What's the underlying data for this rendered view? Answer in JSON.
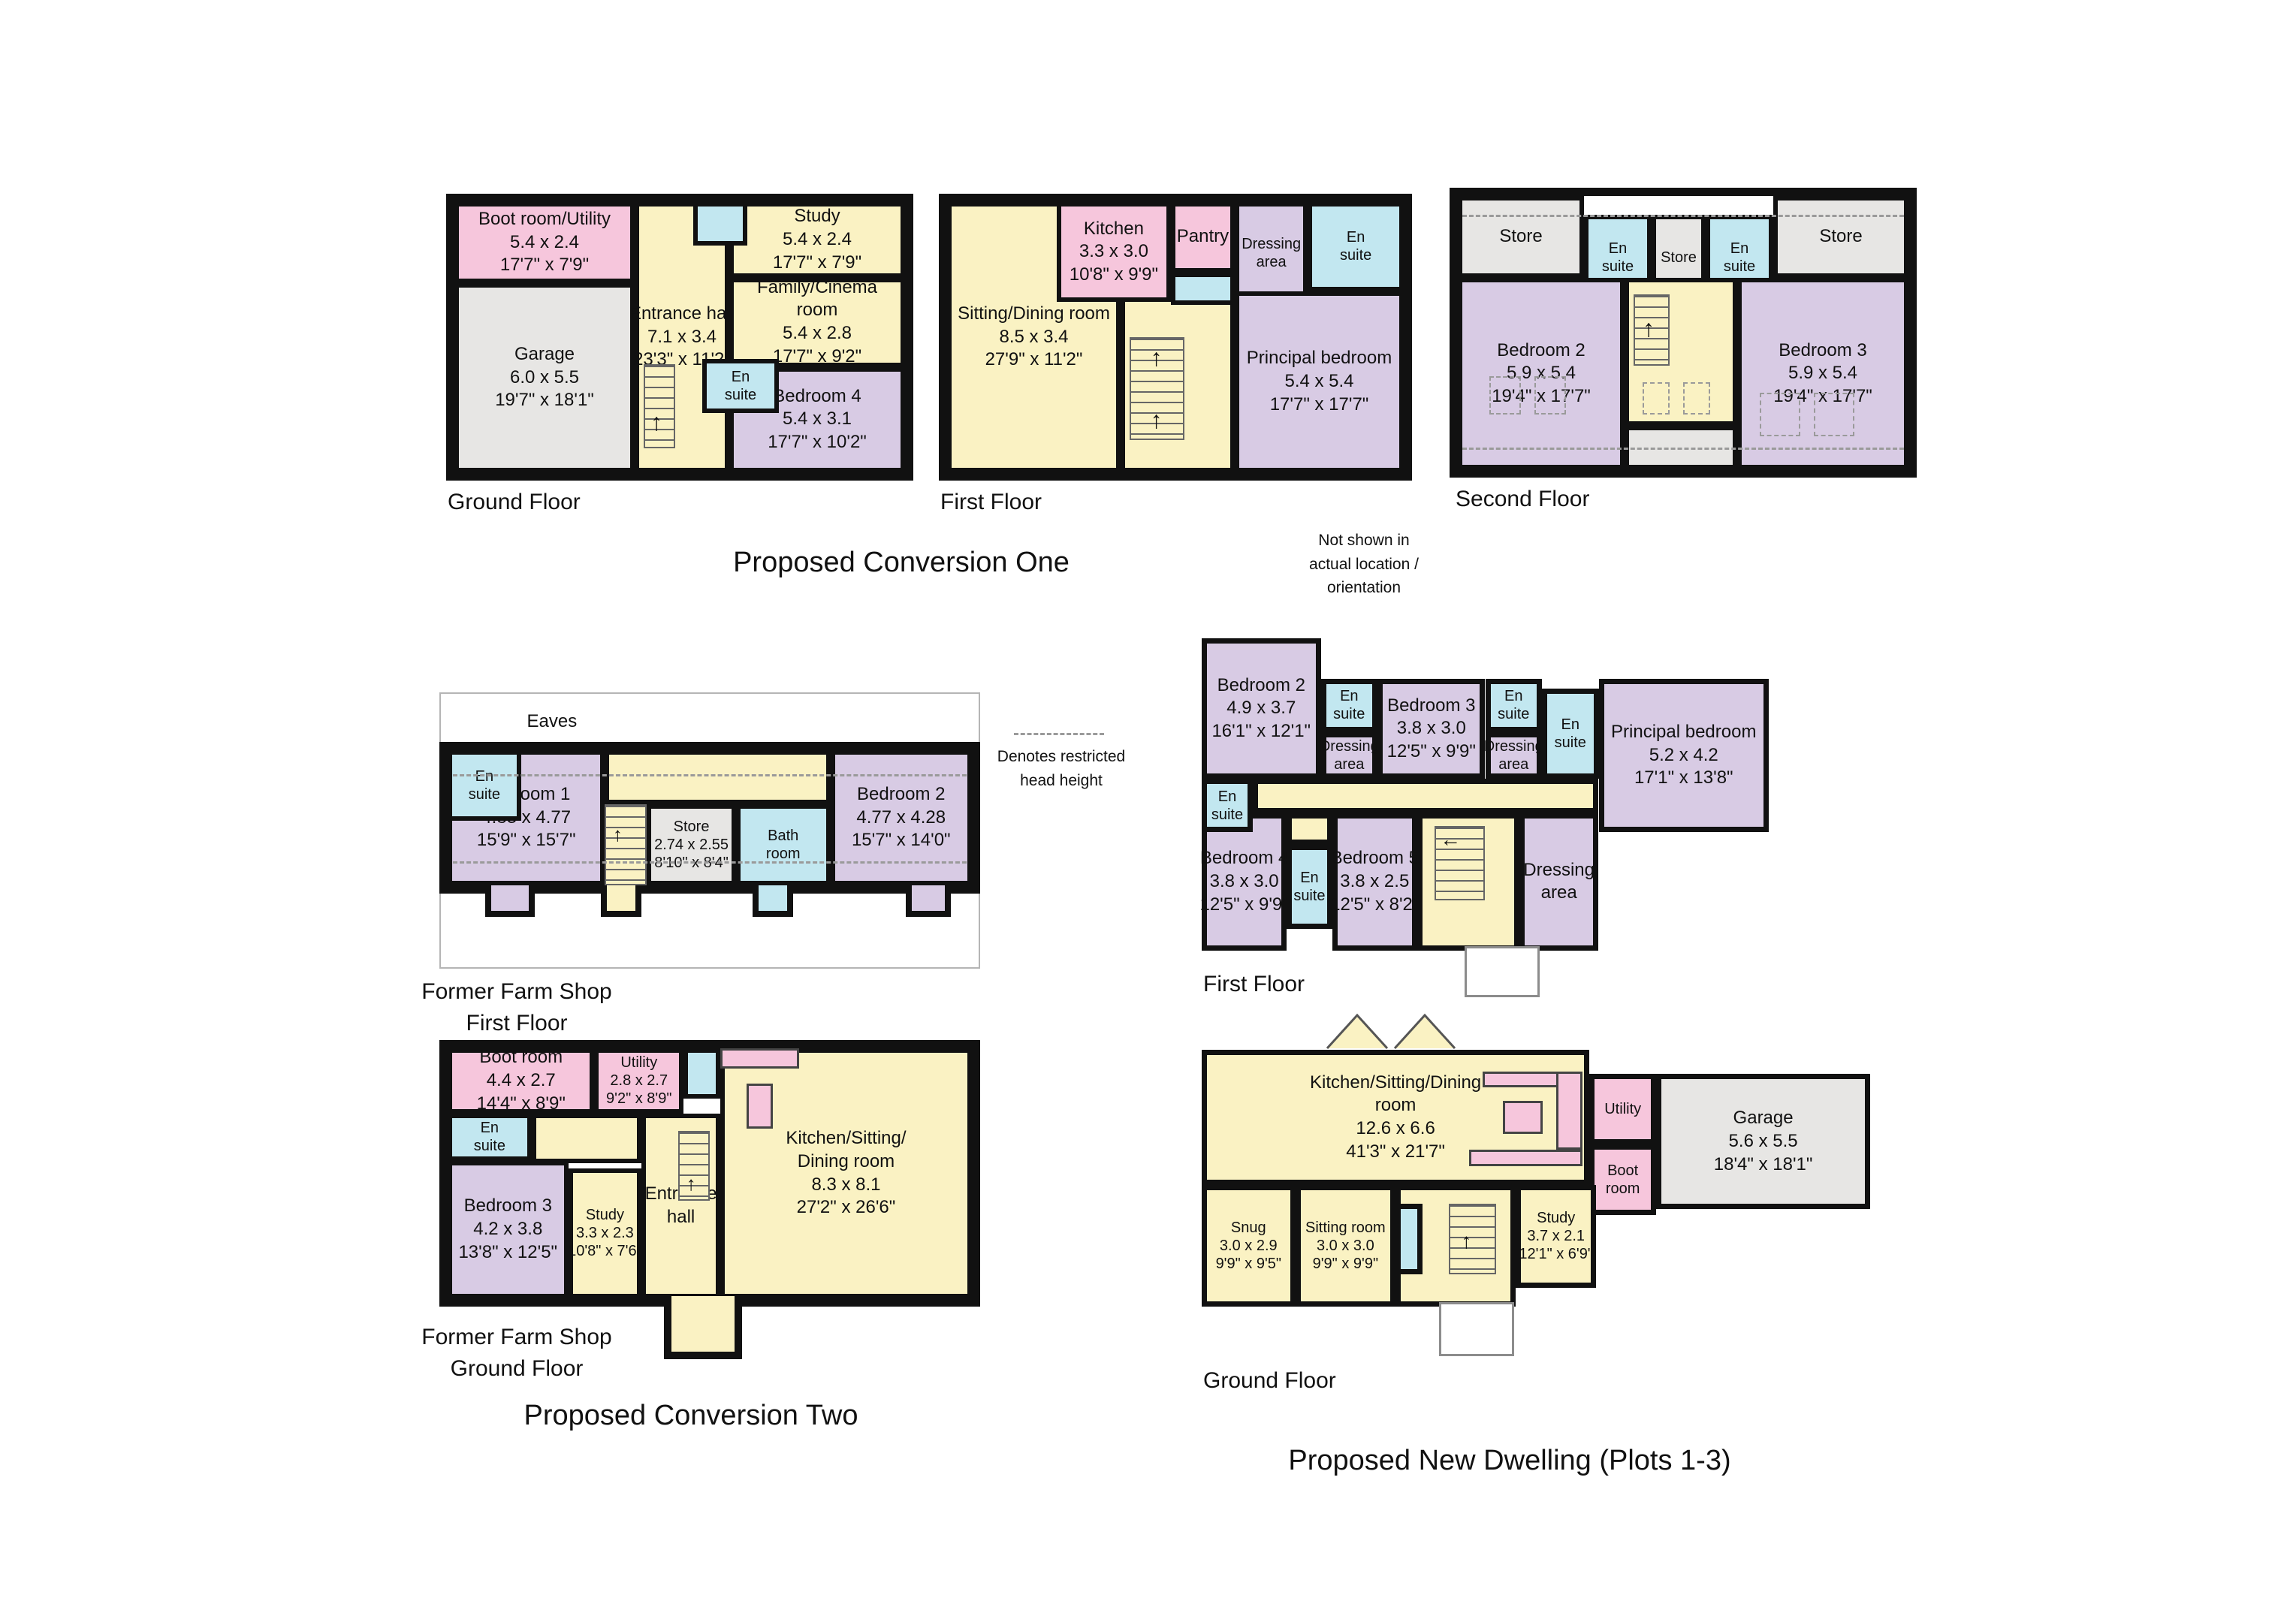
{
  "titles": {
    "conversion_one": "Proposed Conversion One",
    "conversion_two": "Proposed Conversion Two",
    "new_dwelling": "Proposed New Dwelling (Plots 1-3)"
  },
  "notes": {
    "orientation_lines": [
      "Not shown in",
      "actual location /",
      "orientation"
    ],
    "restricted_lines": [
      "Denotes restricted",
      "head height"
    ]
  },
  "colors": {
    "wall": "#111111",
    "room_pink": "#F6C6DC",
    "room_yellow": "#FAF2C3",
    "room_purple": "#D8CBE4",
    "room_blue": "#C2E7F0",
    "room_grey": "#E7E6E4"
  },
  "plans": {
    "c1_ground": {
      "caption": "Ground Floor",
      "rooms": {
        "boot": {
          "lines": [
            "Boot room/Utility",
            "5.4 x 2.4",
            "17'7\" x 7'9\""
          ]
        },
        "garage": {
          "lines": [
            "Garage",
            "6.0 x 5.5",
            "19'7\" x 18'1\""
          ]
        },
        "hall": {
          "lines": [
            "Entrance hall",
            "7.1 x 3.4",
            "23'3\" x 11'2\""
          ]
        },
        "study": {
          "lines": [
            "Study",
            "5.4 x 2.4",
            "17'7\" x 7'9\""
          ]
        },
        "family": {
          "lines": [
            "Family/Cinema",
            "room",
            "5.4 x 2.8",
            "17'7\" x 9'2\""
          ]
        },
        "ensuite": {
          "lines": [
            "En",
            "suite"
          ]
        },
        "bedroom4": {
          "lines": [
            "Bedroom 4",
            "5.4 x 3.1",
            "17'7\" x 10'2\""
          ]
        }
      }
    },
    "c1_first": {
      "caption": "First Floor",
      "rooms": {
        "sitting": {
          "lines": [
            "Sitting/Dining room",
            "8.5 x 3.4",
            "27'9\" x 11'2\""
          ]
        },
        "kitchen": {
          "lines": [
            "Kitchen",
            "3.3 x 3.0",
            "10'8\" x 9'9\""
          ]
        },
        "pantry": {
          "lines": [
            "Pantry"
          ]
        },
        "dressing": {
          "lines": [
            "Dressing",
            "area"
          ]
        },
        "ensuite": {
          "lines": [
            "En",
            "suite"
          ]
        },
        "principal": {
          "lines": [
            "Principal bedroom",
            "5.4 x 5.4",
            "17'7\" x 17'7\""
          ]
        }
      }
    },
    "c1_second": {
      "caption": "Second Floor",
      "rooms": {
        "store_left": {
          "lines": [
            "Store"
          ]
        },
        "ensuite_left": {
          "lines": [
            "En",
            "suite"
          ]
        },
        "store_mid": {
          "lines": [
            "Store"
          ]
        },
        "ensuite_right": {
          "lines": [
            "En",
            "suite"
          ]
        },
        "store_right": {
          "lines": [
            "Store"
          ]
        },
        "bedroom2": {
          "lines": [
            "Bedroom 2",
            "5.9 x 5.4",
            "19'4\" x 17'7\""
          ]
        },
        "bedroom3": {
          "lines": [
            "Bedroom 3",
            "5.9 x 5.4",
            "19'4\" x 17'7\""
          ]
        }
      }
    },
    "ffs_first": {
      "caption_lines": [
        "Former Farm Shop",
        "First Floor"
      ],
      "eaves": "Eaves",
      "rooms": {
        "ensuite": {
          "lines": [
            "En",
            "suite"
          ]
        },
        "bedroom1": {
          "lines": [
            "Bedroom 1",
            "4.83 x 4.77",
            "15'9\" x 15'7\""
          ]
        },
        "store": {
          "lines": [
            "Store",
            "2.74 x 2.55",
            "8'10\" x 8'4\""
          ]
        },
        "bath": {
          "lines": [
            "Bath",
            "room"
          ]
        },
        "bedroom2": {
          "lines": [
            "Bedroom 2",
            "4.77 x 4.28",
            "15'7\" x 14'0\""
          ]
        }
      }
    },
    "ffs_ground": {
      "caption_lines": [
        "Former Farm Shop",
        "Ground Floor"
      ],
      "rooms": {
        "boot": {
          "lines": [
            "Boot room",
            "4.4 x 2.7",
            "14'4\" x 8'9\""
          ]
        },
        "utility": {
          "lines": [
            "Utility",
            "2.8 x 2.7",
            "9'2\" x 8'9\""
          ]
        },
        "ensuite": {
          "lines": [
            "En",
            "suite"
          ]
        },
        "bedroom3": {
          "lines": [
            "Bedroom 3",
            "4.2 x 3.8",
            "13'8\" x 12'5\""
          ]
        },
        "study": {
          "lines": [
            "Study",
            "3.3 x 2.3",
            "10'8\" x 7'6\""
          ]
        },
        "hall": {
          "lines": [
            "Entrance",
            "hall"
          ]
        },
        "kitchen": {
          "lines": [
            "Kitchen/Sitting/",
            "Dining room",
            "8.3 x 8.1",
            "27'2\" x 26'6\""
          ]
        }
      }
    },
    "nd_first": {
      "caption": "First Floor",
      "rooms": {
        "bedroom2": {
          "lines": [
            "Bedroom 2",
            "4.9 x 3.7",
            "16'1\" x 12'1\""
          ]
        },
        "ensuite_b2": {
          "lines": [
            "En",
            "suite"
          ]
        },
        "dressing_b2": {
          "lines": [
            "Dressing",
            "area"
          ]
        },
        "bedroom3": {
          "lines": [
            "Bedroom 3",
            "3.8 x 3.0",
            "12'5\" x 9'9\""
          ]
        },
        "ensuite_b3": {
          "lines": [
            "En",
            "suite"
          ]
        },
        "dressing_b3": {
          "lines": [
            "Dressing",
            "area"
          ]
        },
        "ensuite_principal": {
          "lines": [
            "En",
            "suite"
          ]
        },
        "principal": {
          "lines": [
            "Principal bedroom",
            "5.2 x 4.2",
            "17'1\" x 13'8\""
          ]
        },
        "ensuite_left": {
          "lines": [
            "En",
            "suite"
          ]
        },
        "bedroom4": {
          "lines": [
            "Bedroom 4",
            "3.8 x 3.0",
            "12'5\" x 9'9\""
          ]
        },
        "ensuite_b5": {
          "lines": [
            "En",
            "suite"
          ]
        },
        "bedroom5": {
          "lines": [
            "Bedroom 5",
            "3.8 x 2.5",
            "12'5\" x 8'2\""
          ]
        },
        "dressing_landing": {
          "lines": [
            "Dressing",
            "area"
          ]
        }
      }
    },
    "nd_ground": {
      "caption": "Ground Floor",
      "rooms": {
        "kitchen": {
          "lines": [
            "Kitchen/Sitting/Dining",
            "room",
            "12.6 x 6.6",
            "41'3\" x 21'7\""
          ]
        },
        "utility": {
          "lines": [
            "Utility"
          ]
        },
        "boot": {
          "lines": [
            "Boot",
            "room"
          ]
        },
        "garage": {
          "lines": [
            "Garage",
            "5.6 x 5.5",
            "18'4\" x 18'1\""
          ]
        },
        "snug": {
          "lines": [
            "Snug",
            "3.0 x 2.9",
            "9'9\" x 9'5\""
          ]
        },
        "sitting": {
          "lines": [
            "Sitting room",
            "3.0 x 3.0",
            "9'9\" x 9'9\""
          ]
        },
        "study": {
          "lines": [
            "Study",
            "3.7 x 2.1",
            "12'1\" x 6'9\""
          ]
        }
      }
    }
  }
}
